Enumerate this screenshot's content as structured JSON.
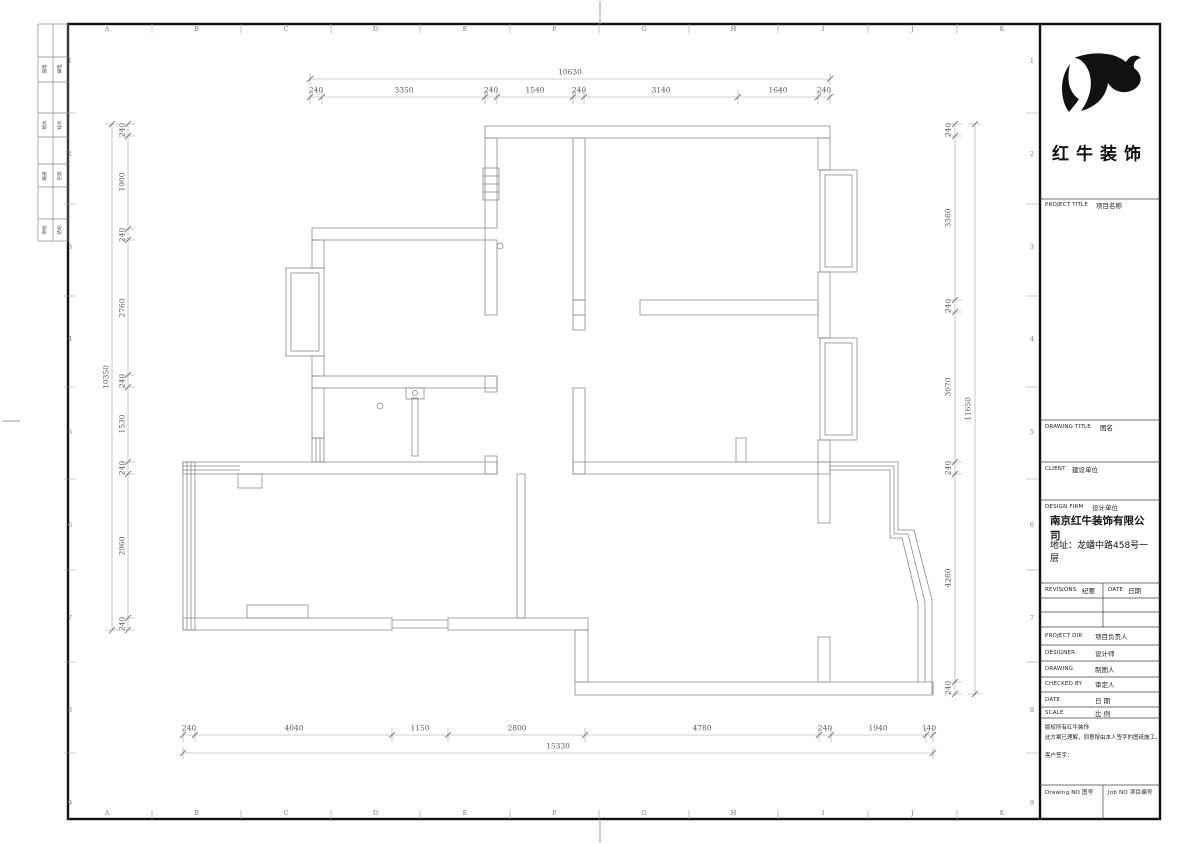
{
  "sheet": {
    "grid_letters": [
      "A",
      "B",
      "C",
      "D",
      "E",
      "F",
      "G",
      "H",
      "I",
      "J",
      "K"
    ],
    "grid_numbers": [
      "1",
      "2",
      "3",
      "4",
      "5",
      "6",
      "7",
      "8",
      "9"
    ]
  },
  "side_strip": {
    "rows": [
      [
        "强电",
        "弱电"
      ],
      [
        "给水",
        "排水"
      ],
      [
        "暖通",
        "空调"
      ],
      [
        "原始",
        "结构"
      ]
    ]
  },
  "dims": {
    "top": {
      "total": "10630",
      "segments": [
        "240",
        "3350",
        "240",
        "1540",
        "240",
        "3140",
        "1640",
        "240"
      ]
    },
    "left": {
      "total": "10350",
      "segments": [
        "240",
        "1900",
        "240",
        "2760",
        "240",
        "1530",
        "240",
        "2960",
        "240"
      ]
    },
    "right": {
      "total": "11650",
      "segments": [
        "240",
        "3360",
        "240",
        "3070",
        "240",
        "4260",
        "240"
      ]
    },
    "bottom": {
      "total": "15330",
      "segments": [
        "240",
        "4040",
        "1150",
        "2800",
        "4780",
        "240",
        "1940",
        "140"
      ]
    }
  },
  "title_block": {
    "brand": "红牛装饰",
    "project_title_en": "PROJECT TITLE",
    "project_title_cn": "项目名称",
    "drawing_title_en": "DRAWING TITLE",
    "drawing_title_cn": "图名",
    "client_en": "CLIENT",
    "client_cn": "建设单位",
    "design_firm_en": "DESIGN FIRM",
    "design_firm_cn": "设计单位",
    "company": "南京红牛装饰有限公司",
    "address": "地址：龙蟠中路458号一层",
    "revisions_en": "REVISIONS",
    "revisions_cn": "纪要",
    "date_hdr_en": "DATE",
    "date_hdr_cn": "日期",
    "project_dir_en": "PROJECT DIR",
    "project_dir_cn": "项目负责人",
    "designer_en": "DESIGNER",
    "designer_cn": "设计师",
    "drawing_en": "DRAWING",
    "drawing_cn": "制图人",
    "checked_en": "CHECKED BY",
    "checked_cn": "审定人",
    "date_en": "DATE",
    "date_cn": "日 期",
    "scale_en": "SCALE",
    "scale_cn": "比 例",
    "copyright_1": "版权所有红牛装饰",
    "copyright_2": "此方案已理解，同意按由本人签字的图纸施工。",
    "copyright_3": "客户签字：",
    "drawing_no": "Drawing NO 图号",
    "job_no": "Job NO 项目编号"
  }
}
